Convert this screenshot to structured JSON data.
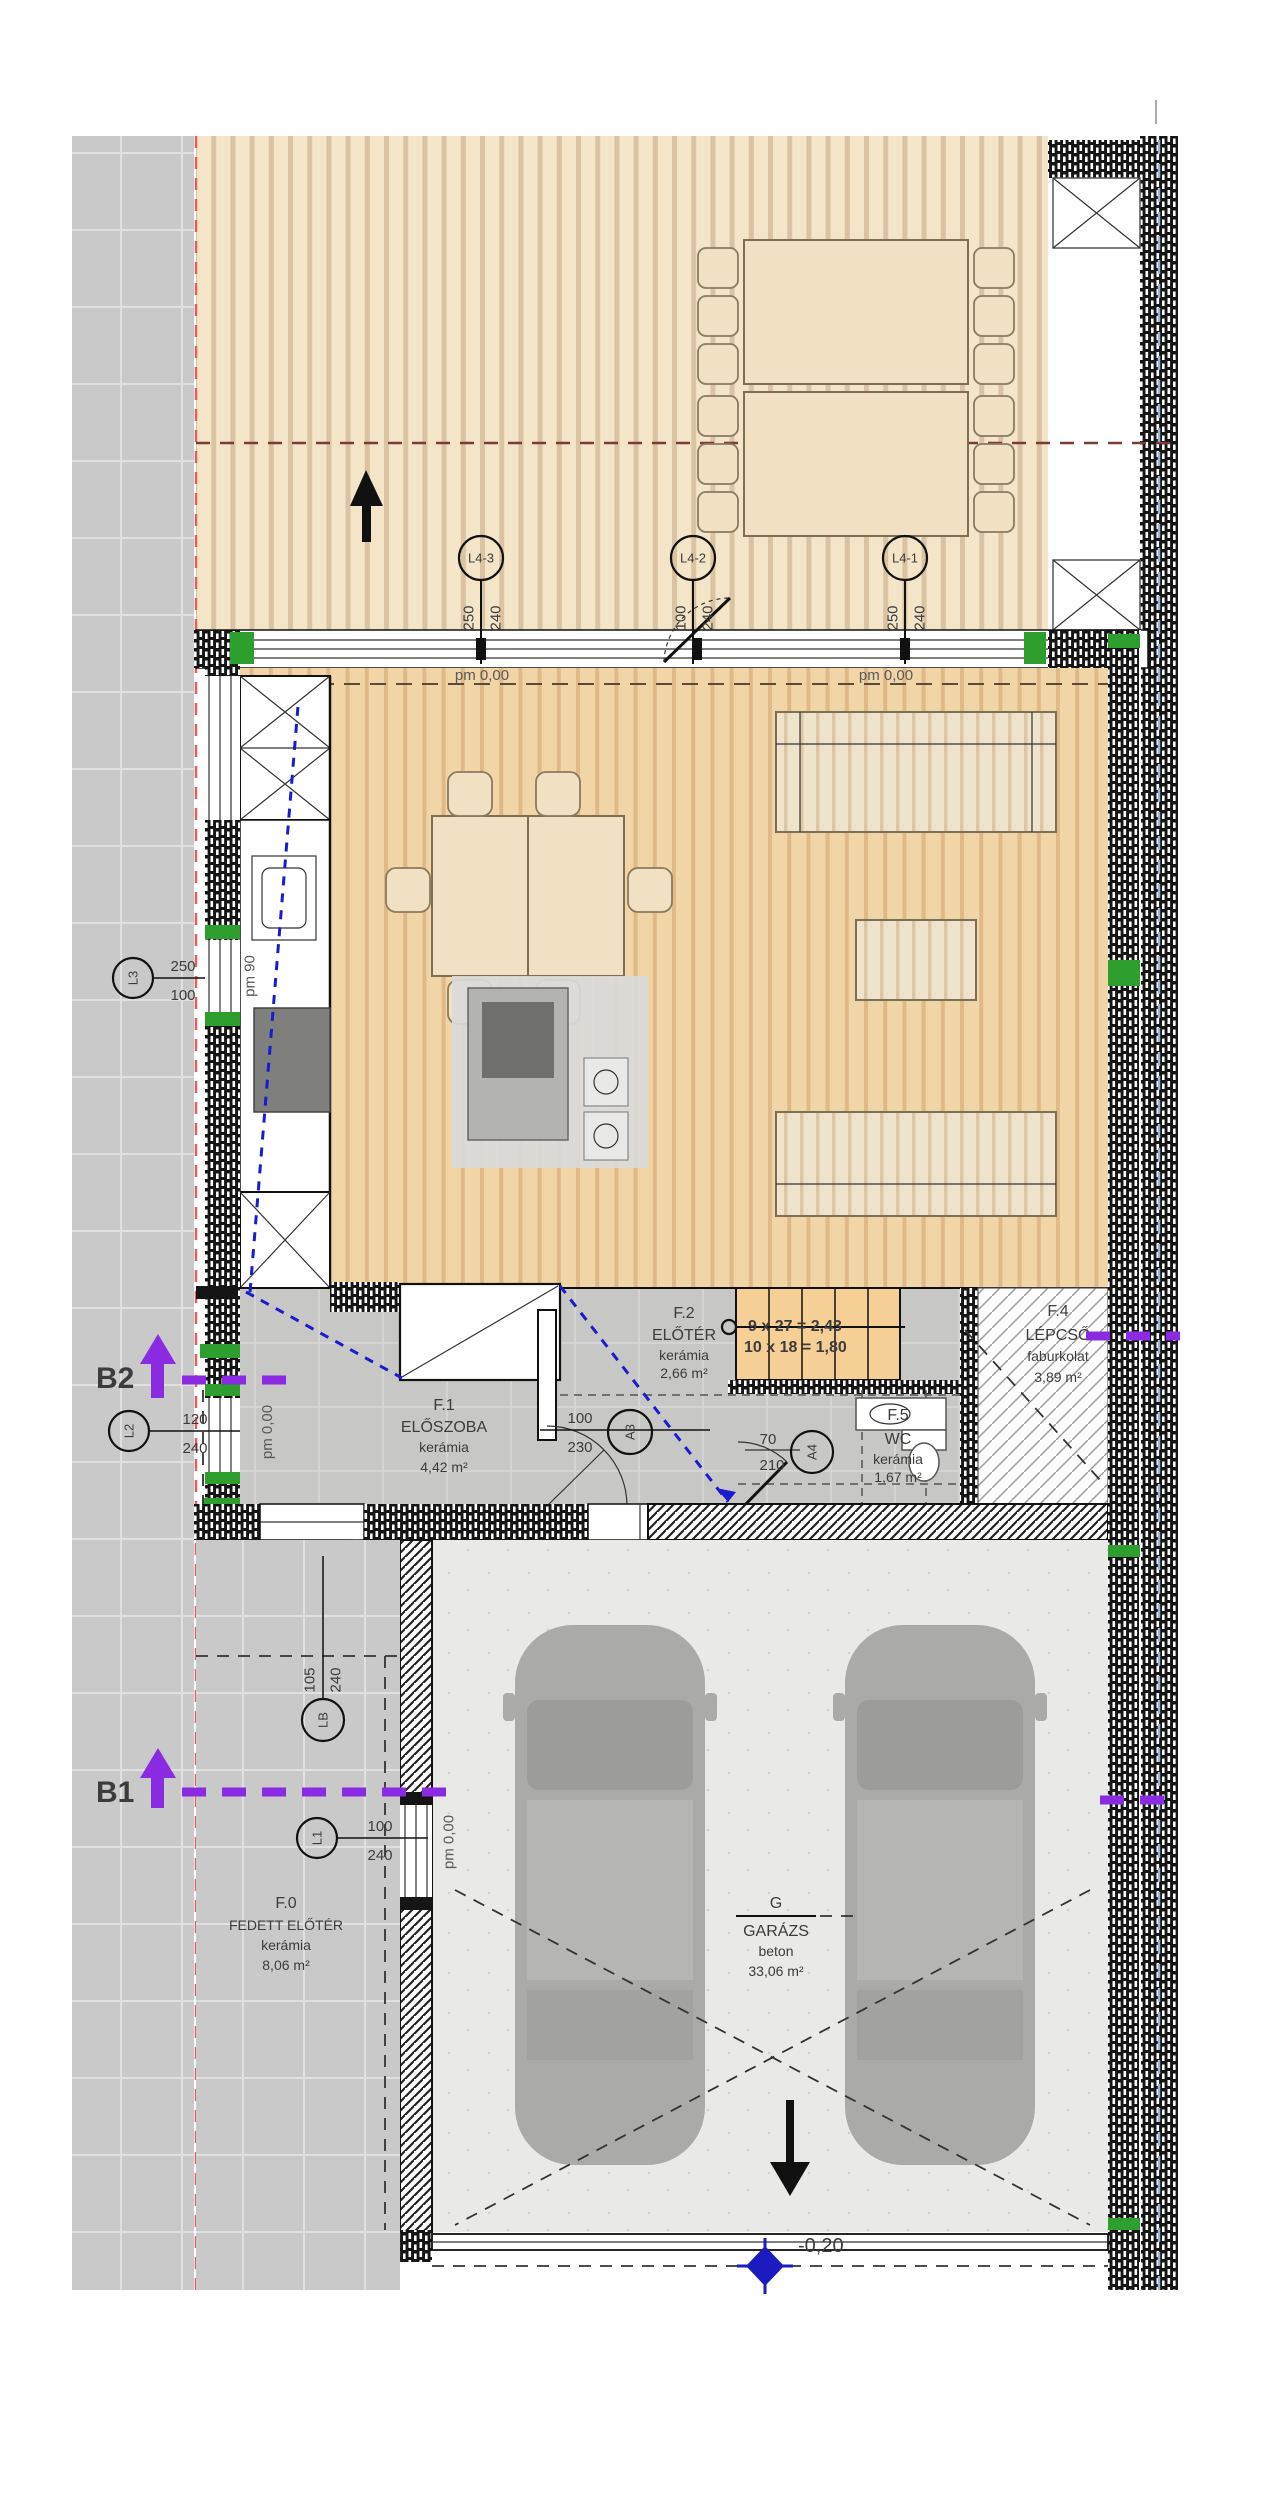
{
  "rooms": {
    "f1": {
      "id": "F.1",
      "name": "ELŐSZOBA",
      "finish": "kerámia",
      "area": "4,42 m²"
    },
    "f2": {
      "id": "F.2",
      "name": "ELŐTÉR",
      "finish": "kerámia",
      "area": "2,66 m²"
    },
    "f4": {
      "id": "F.4",
      "name": "LÉPCSŐ",
      "finish": "faburkolat",
      "area": "3,89 m²"
    },
    "f5": {
      "id": "F.5",
      "name": "WC",
      "finish": "kerámia",
      "area": "1,67 m²"
    },
    "f0": {
      "id": "F.0",
      "name": "FEDETT ELŐTÉR",
      "finish": "kerámia",
      "area": "8,06 m²"
    },
    "g": {
      "id": "G",
      "name": "GARÁZS",
      "finish": "beton",
      "area": "33,06 m²"
    }
  },
  "levels": {
    "pm000": "pm 0,00",
    "pm90": "pm 90",
    "minus020": "-0,20"
  },
  "stair": {
    "line1": "9 x 27 = 2,43",
    "line2": "10 x 18 = 1,80"
  },
  "sections": {
    "b1": "B1",
    "b2": "B2"
  },
  "openings": {
    "l4_3": {
      "id": "L4-3",
      "w": "250",
      "h": "240"
    },
    "l4_2": {
      "id": "L4-2",
      "w": "100",
      "h": "240"
    },
    "l4_1": {
      "id": "L4-1",
      "w": "250",
      "h": "240"
    },
    "l3": {
      "id": "L3",
      "w": "250",
      "h": "100"
    },
    "l2": {
      "id": "L2",
      "w": "120",
      "h": "240"
    },
    "l1": {
      "id": "L1",
      "w": "100",
      "h": "240"
    },
    "lb": {
      "id": "LB",
      "w": "105",
      "h": "240"
    },
    "a3": {
      "id": "A3",
      "w": "100",
      "h": "230"
    },
    "a4": {
      "id": "A4",
      "w": "70",
      "h": "210"
    }
  },
  "garage_door": {
    "w": "100",
    "h": "210"
  },
  "colors": {
    "section_purple": "#8a2be2",
    "stair_purple": "#7a4fd0",
    "level_blue": "#4646b6",
    "marker_blue": "#1b1bbf",
    "property_red": "#e06060",
    "setback_brown": "#7a3b3b",
    "sight_blue": "#1b1bcf",
    "green_cap": "#2e9e2e",
    "deck": "#f4e4c8",
    "wood_floor": "#f2d5a6",
    "ceramic_gray": "#c7c7c5",
    "paving_gray": "#c9c9c9",
    "concrete": "#e9e9e7",
    "car_gray": "#aaaaa8",
    "tread_orange": "#f6cf96"
  }
}
